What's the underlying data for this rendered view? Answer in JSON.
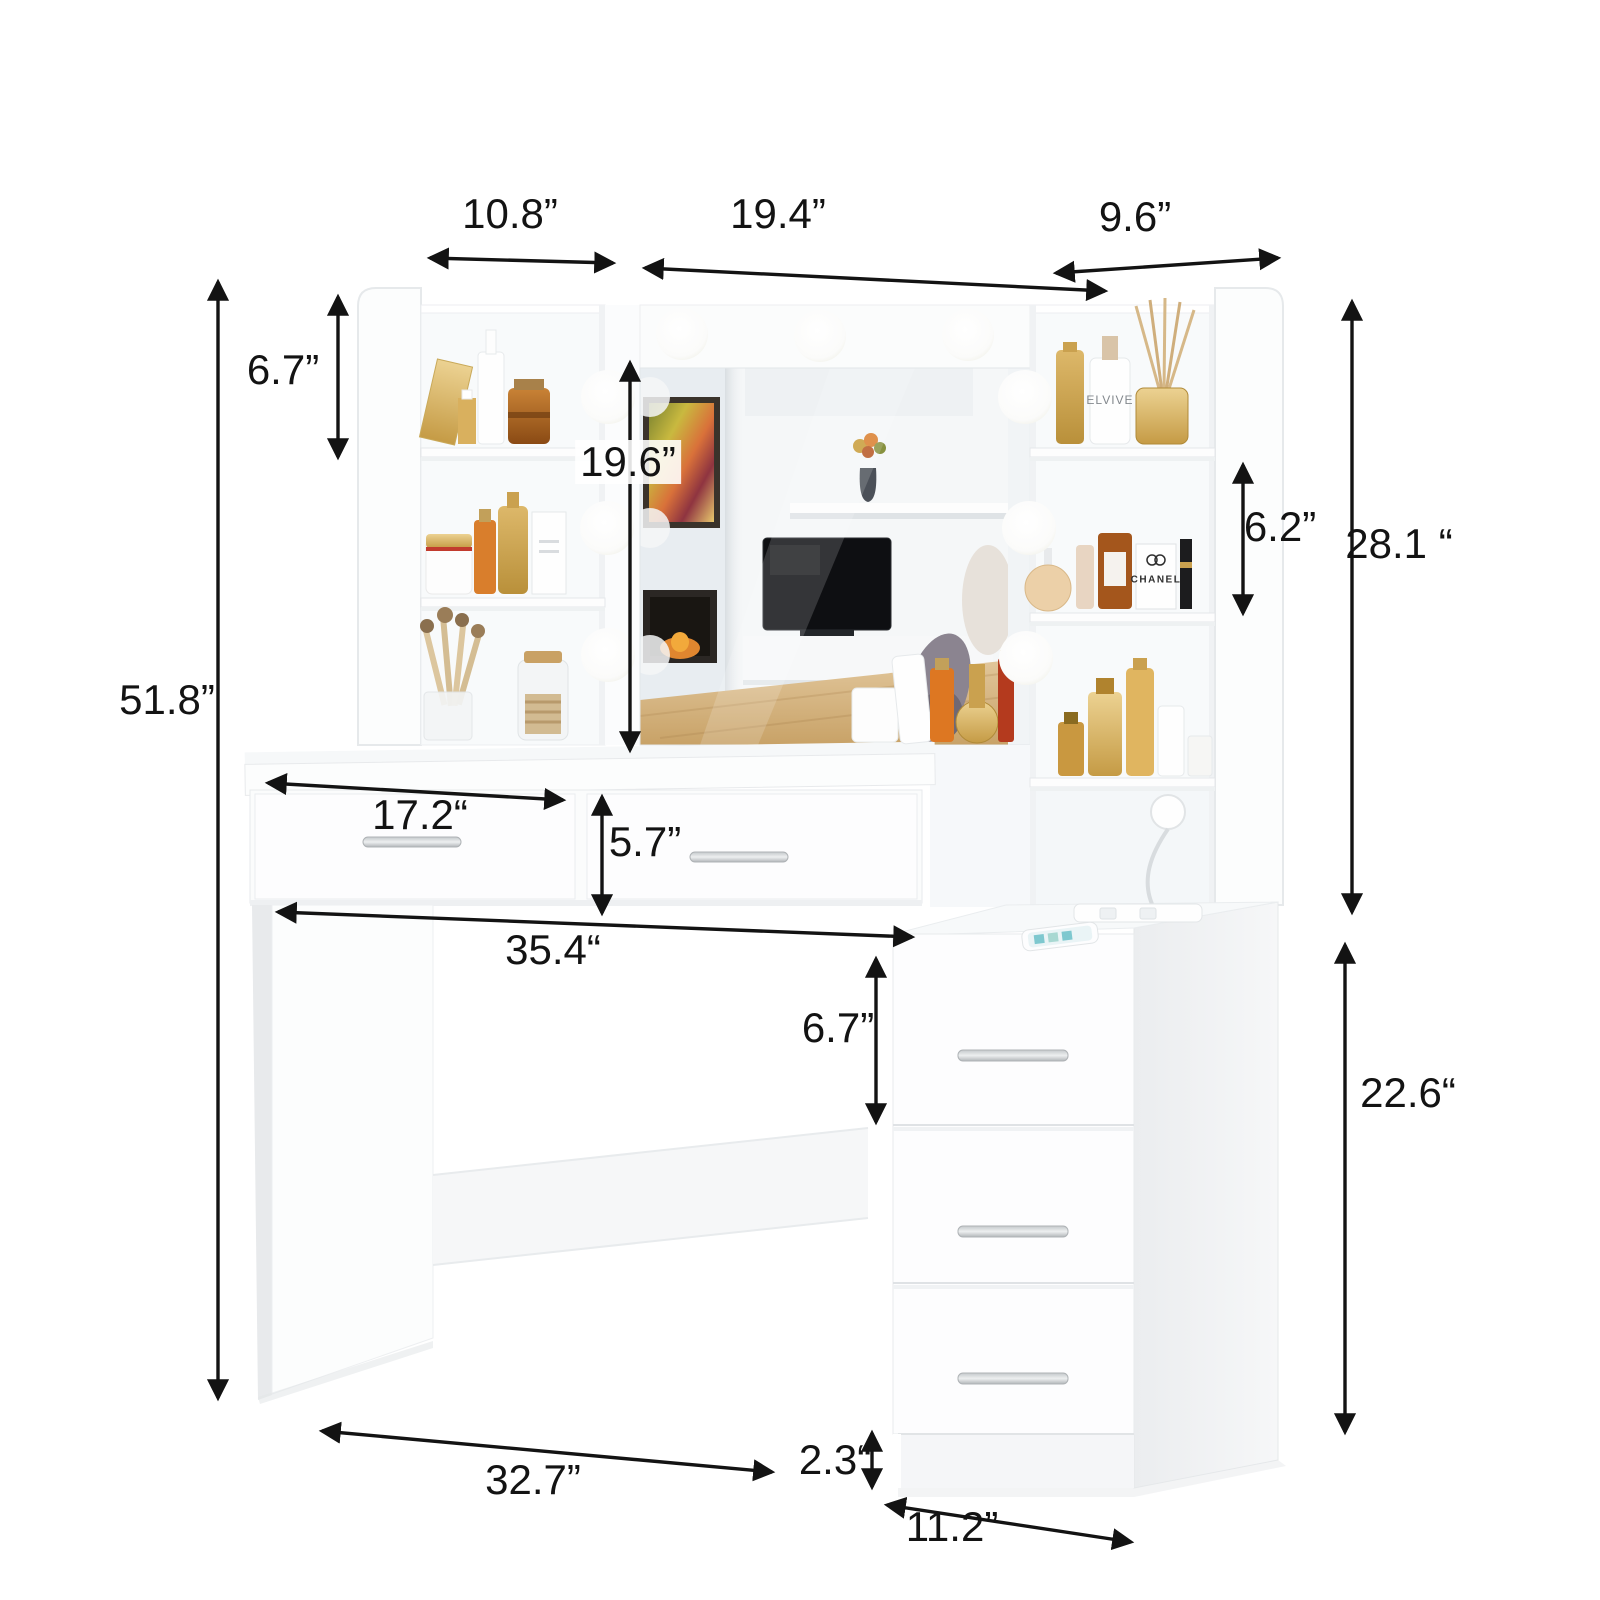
{
  "dimensions": {
    "hutch_left_width": {
      "label": "10.8”"
    },
    "mirror_width": {
      "label": "19.4”"
    },
    "hutch_right_width": {
      "label": "9.6”"
    },
    "left_shelf_spacing": {
      "label": "6.7”"
    },
    "mirror_height": {
      "label": "19.6”"
    },
    "right_shelf_spacing": {
      "label": "6.2”"
    },
    "hutch_height": {
      "label": "28.1 “"
    },
    "overall_height": {
      "label": "51.8”"
    },
    "desk_drawer_width": {
      "label": "17.2“"
    },
    "desk_drawer_height": {
      "label": "5.7”"
    },
    "desktop_width": {
      "label": "35.4“"
    },
    "cabinet_drawer_height": {
      "label": "6.7”"
    },
    "cabinet_height": {
      "label": "22.6“"
    },
    "leg_to_cabinet_width": {
      "label": "32.7”"
    },
    "base_height": {
      "label": "2.3“"
    },
    "cabinet_width": {
      "label": "11.2”"
    }
  },
  "brands": {
    "elvive": "ELVIVE",
    "chanel": "CHANEL"
  },
  "colors": {
    "furniture_white": "#fdfdfd",
    "annotation_black": "#131313",
    "gold_accent": "#c9a254",
    "wood_floor": "#d3ad7a"
  },
  "lighting": {
    "bulb_count": 9
  }
}
